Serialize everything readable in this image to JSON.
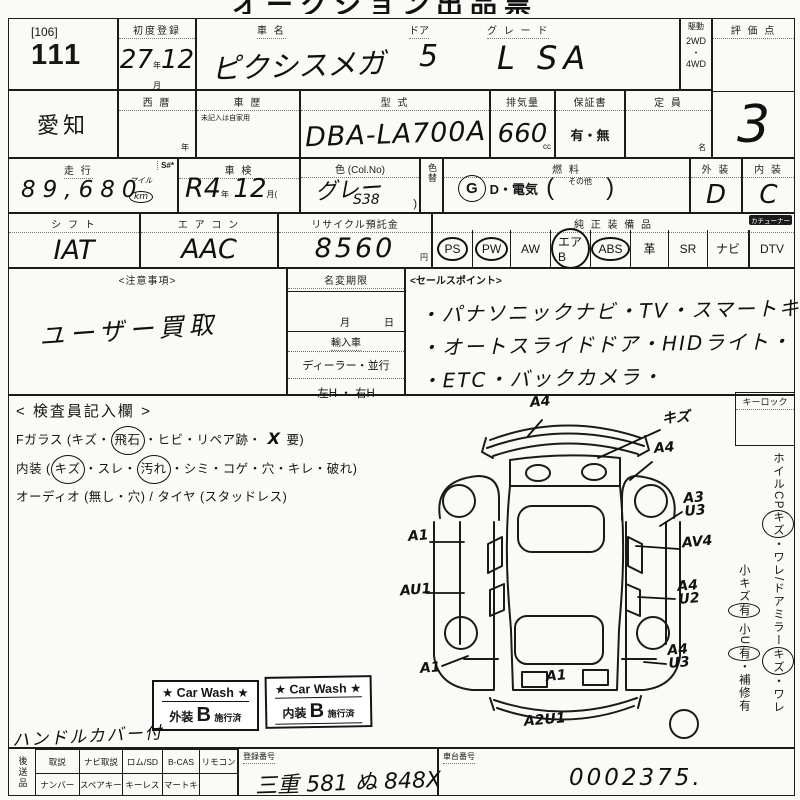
{
  "colors": {
    "ink": "#1b1b1b",
    "paper": "#fafaf7"
  },
  "title": {
    "clipped": "オークション出品票"
  },
  "lot": {
    "bracket": "[106]",
    "number": "111"
  },
  "header_row": {
    "first_reg_label": "初度登録",
    "first_reg_year": "27",
    "year_unit": "年",
    "first_reg_month": "12",
    "month_unit": "月",
    "car_name_label": "車  名",
    "car_name": "ピクシスメガ",
    "door_label": "ドア",
    "door": "5",
    "grade_label": "グ レ ー ド",
    "grade": "L SA",
    "drive_label": "駆動",
    "drive_top": "2WD",
    "drive_sep": "・",
    "drive_bottom": "4WD",
    "score_label": "評 価 点",
    "score": "3"
  },
  "row2": {
    "prefecture": "愛知",
    "seireki_label": "西  暦",
    "seireki_unit": "年",
    "history_label": "車  歴",
    "history_note": "未記入は自家用",
    "model_label": "型  式",
    "model": "DBA-LA700A",
    "disp_label": "排気量",
    "disp": "660",
    "disp_unit": "cc",
    "warranty_label": "保証書",
    "warranty": "有・無",
    "capacity_label": "定  員",
    "capacity_unit": "名"
  },
  "row3": {
    "mileage_label": "走  行",
    "s_label": "S#*",
    "mileage": "89,680",
    "mile_unit": "マイル",
    "km_unit": "km",
    "shaken_label": "車  検",
    "shaken_era": "R",
    "shaken_year": "4",
    "shaken_year_unit": "年",
    "shaken_month": "12",
    "shaken_month_unit": "月(",
    "color_label": "色 (Col.No)",
    "color": "グレー",
    "color_no": "S38",
    "color_paren": ")",
    "color_change_label": "色替",
    "fuel_label": "燃  料",
    "fuel_g": "G",
    "fuel_rest": "D・電気",
    "fuel_open": "(",
    "fuel_other": "その他",
    "fuel_close": ")",
    "ext_label": "外 装",
    "ext": "D",
    "int_label": "内 装",
    "int": "C"
  },
  "row4": {
    "shift_label": "シ フ ト",
    "shift": "IAT",
    "aircon_label": "エ ア コ ン",
    "aircon": "AAC",
    "recycle_label": "リサイクル預託金",
    "recycle": "8560",
    "yen": "円",
    "equip_label": "純 正 装 備 品",
    "tuner_note": "カチューナー",
    "equipment": [
      {
        "label": "PS",
        "circled": true
      },
      {
        "label": "PW",
        "circled": true
      },
      {
        "label": "AW",
        "circled": false
      },
      {
        "label": "エアB",
        "circled": true
      },
      {
        "label": "ABS",
        "circled": true
      },
      {
        "label": "革",
        "circled": false
      },
      {
        "label": "SR",
        "circled": false
      },
      {
        "label": "ナビ",
        "circled": false
      },
      {
        "label": "DTV",
        "circled": false
      }
    ]
  },
  "notes": {
    "caution_label": "<注意事項>",
    "caution_text": "ユーザー買取",
    "rename_label": "名変期限",
    "month": "月",
    "day": "日",
    "import_label": "輸入車",
    "import_options": "ディーラー・並行",
    "handle_options": "左H ・ 右H",
    "sales_label": "<セールスポイント>",
    "sales_lines": [
      "・パナソニックナビ・TV・スマートキー・",
      "・オートスライドドア・HIDライト・",
      "・ETC・バックカメラ・"
    ]
  },
  "inspection": {
    "title": "< 検査員記入欄 >",
    "lines": [
      {
        "segs": [
          {
            "t": "Fガラス (キズ・"
          },
          {
            "t": "飛石",
            "c": true
          },
          {
            "t": "・ヒビ・リペア跡・"
          },
          {
            "t": " X ",
            "hw": true
          },
          {
            "t": "要)"
          }
        ]
      },
      {
        "segs": [
          {
            "t": "内装 ("
          },
          {
            "t": "キズ",
            "c": true
          },
          {
            "t": "・スレ・"
          },
          {
            "t": "汚れ",
            "c": true
          },
          {
            "t": "・シミ・コゲ・穴・キレ・破れ)"
          }
        ]
      },
      {
        "segs": [
          {
            "t": "オーディオ (無し・穴) / タイヤ (スタッドレス)"
          }
        ]
      }
    ]
  },
  "right_panel": {
    "keylock_label": "キーロック",
    "col1": [
      {
        "t": "ホイルCP"
      },
      {
        "t": "キズ",
        "c": true
      },
      {
        "t": "・ワレ/ドアミラー"
      },
      {
        "t": "キズ",
        "c": true
      },
      {
        "t": "・ワレ"
      }
    ],
    "col2": [
      {
        "t": "小キズ"
      },
      {
        "t": "有",
        "c": true
      },
      {
        "t": " 小U"
      },
      {
        "t": "有",
        "c": true
      },
      {
        "t": "・補修有"
      }
    ]
  },
  "stamps": {
    "items": [
      {
        "star_line": "★ Car Wash ★",
        "area": "外装",
        "grade": "B",
        "status": "施行済"
      },
      {
        "star_line": "★ Car Wash ★",
        "area": "内装",
        "grade": "B",
        "status": "施行済"
      }
    ]
  },
  "extra_note": "ハンドルカバー付",
  "bottom": {
    "vertical_label": "後送品",
    "row1": [
      "取説",
      "ナビ取説",
      "ロム/SD",
      "B-CAS",
      "リモコン"
    ],
    "row2": [
      "ナンバー",
      "スペアキー",
      "キーレス",
      "スマートキー",
      ""
    ],
    "reg_label": "登録番号",
    "reg_value": "三重 581 ぬ 848X",
    "chassis_label": "車台番号",
    "chassis_value": "0002375."
  },
  "diagram": {
    "markers": [
      {
        "label": "A4",
        "x": 132,
        "y": 2,
        "line": [
          144,
          26,
          130,
          42
        ]
      },
      {
        "label": "キズ",
        "x": 264,
        "y": 18,
        "line": [
          262,
          36,
          200,
          64
        ]
      },
      {
        "label": "A4",
        "x": 256,
        "y": 48,
        "line": [
          254,
          68,
          232,
          86
        ]
      },
      {
        "label": "A3\nU3",
        "x": 286,
        "y": 98,
        "line": [
          284,
          118,
          262,
          132
        ]
      },
      {
        "label": "A1",
        "x": 10,
        "y": 136,
        "line": [
          32,
          148,
          66,
          148
        ]
      },
      {
        "label": "AV4",
        "x": 284,
        "y": 142,
        "line": [
          281,
          155,
          238,
          152
        ]
      },
      {
        "label": "AU1",
        "x": 2,
        "y": 190,
        "line": [
          28,
          199,
          66,
          199
        ]
      },
      {
        "label": "A4\nU2",
        "x": 280,
        "y": 186,
        "line": [
          277,
          205,
          240,
          203
        ]
      },
      {
        "label": "A1",
        "x": 22,
        "y": 268,
        "line": [
          44,
          272,
          70,
          262
        ]
      },
      {
        "label": "A4\nU3",
        "x": 270,
        "y": 250,
        "line": [
          268,
          270,
          246,
          268
        ]
      },
      {
        "label": "A1",
        "x": 148,
        "y": 276
      },
      {
        "label": "A2U1",
        "x": 126,
        "y": 320
      }
    ]
  }
}
